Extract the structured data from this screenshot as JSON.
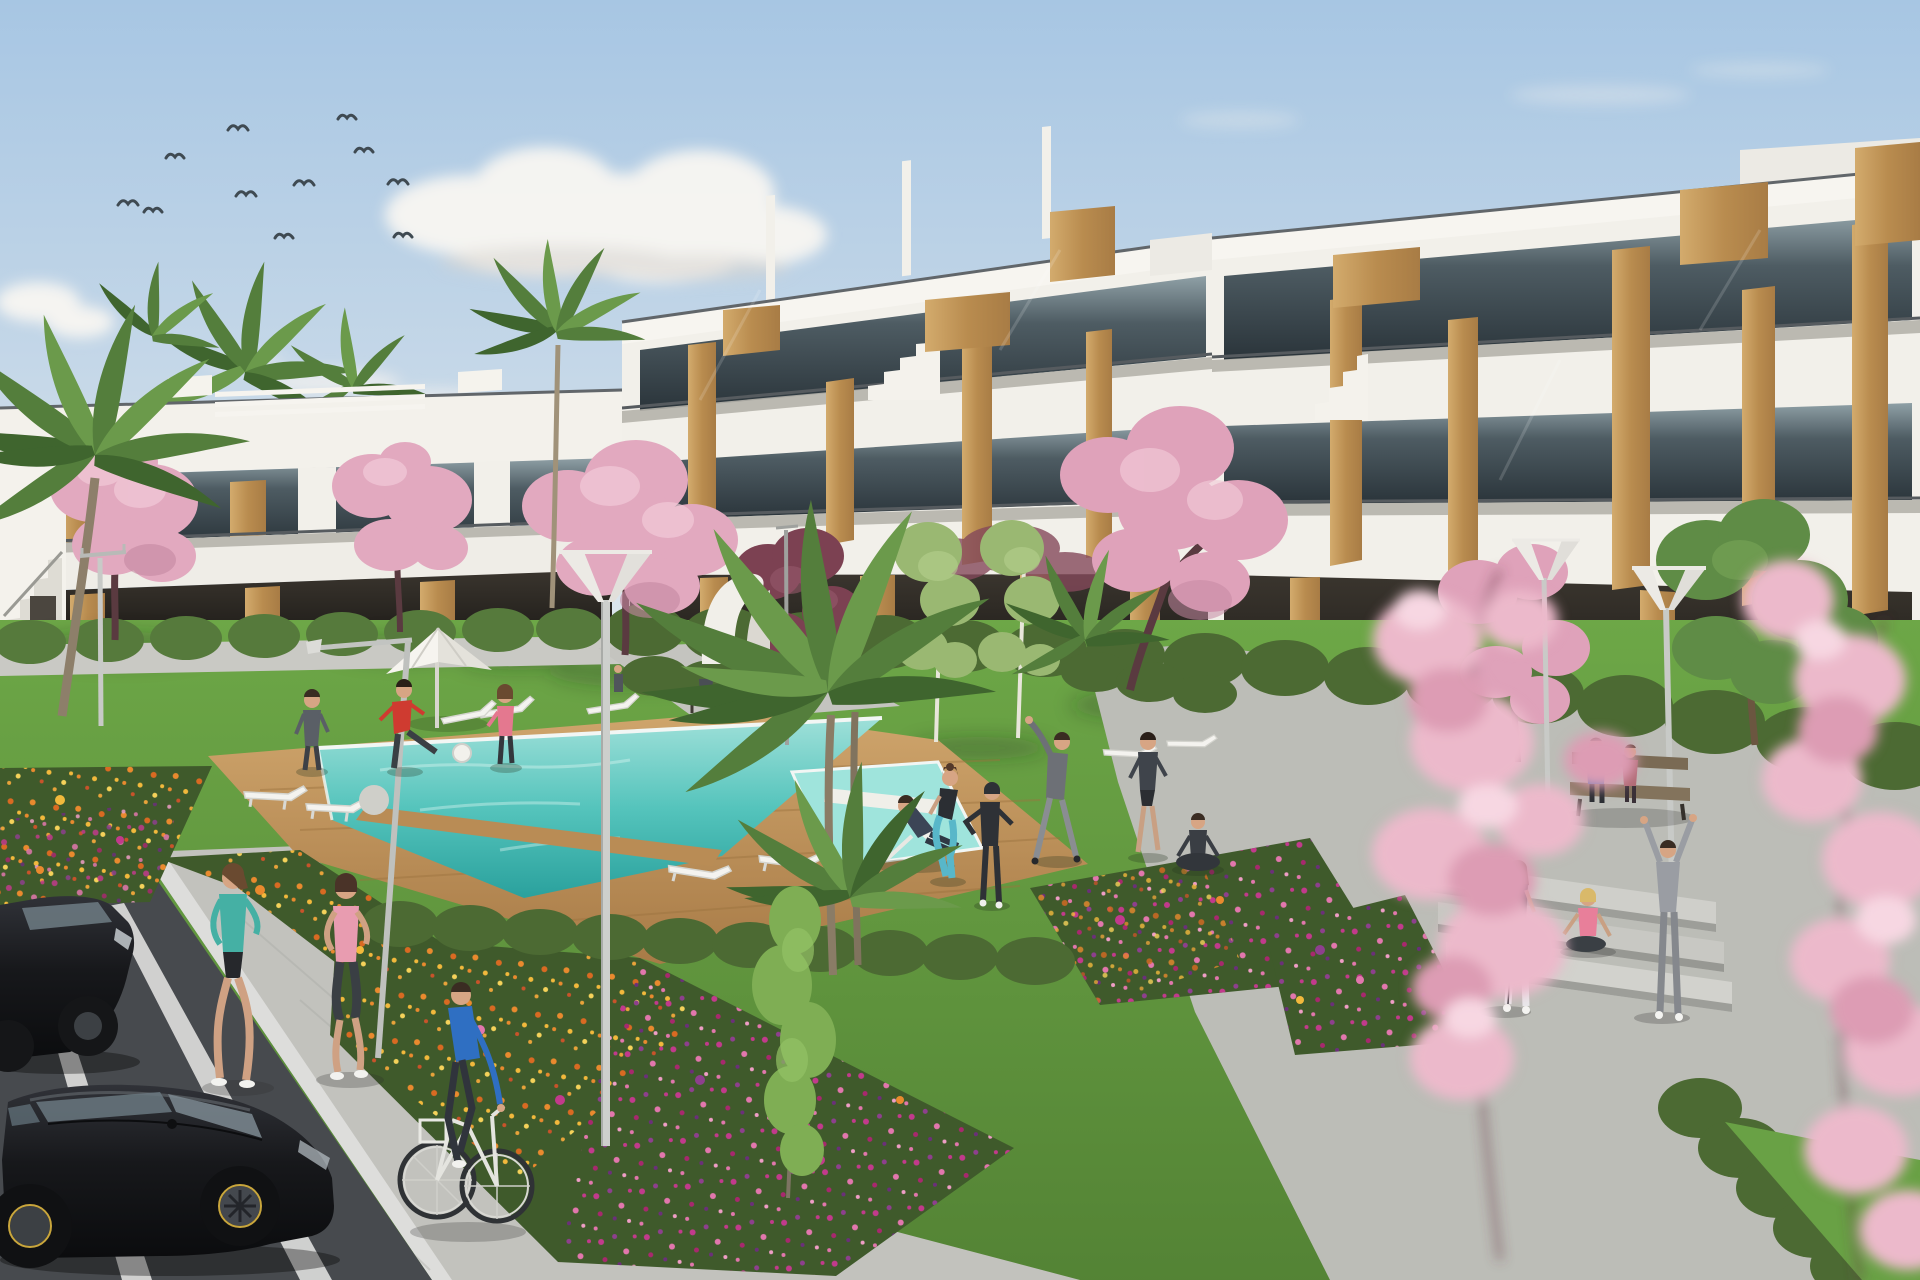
{
  "scene": {
    "type": "photorealistic architectural render",
    "setting": "modern white apartment complex with communal garden, swimming pool and parking on a sunny day",
    "sky": {
      "birds": 11,
      "clouds": "scattered white cumulus and thin wisps"
    },
    "buildings": {
      "right_block": {
        "floors": 3,
        "style": "white modern with glass balconies and timber accent panels",
        "rooftop": "stepped parapets with timber volumes"
      },
      "left_block": {
        "floors": 2,
        "style": "white modern with recessed dark glazing, timber panels and external stair"
      }
    },
    "pool_area": {
      "main_pool": "turquoise pool with wooden deck surround and timber crossing walkway",
      "jacuzzi": "small square pool on the right with white bench plank",
      "sun_loungers": 9,
      "parasols": 1,
      "deck_chairs": 1
    },
    "landscape": {
      "flower_beds": 5,
      "flower_colors": [
        "orange",
        "yellow",
        "magenta",
        "purple",
        "pink"
      ],
      "cherry_blossom_trees": 5,
      "plum_trees": 2,
      "palm_trees": 7,
      "birch_trees": 2,
      "green_trees": 2,
      "hedges": "trimmed rows along buildings and paths",
      "street_lamps": 6,
      "benches": 2,
      "paths": "grey paver walkways with wide steps on the right"
    },
    "vehicles": {
      "parked_cars": 2,
      "car_color": "black",
      "bicycles": 1
    },
    "people_count": 19
  },
  "colors": {
    "sky_top": "#a7c6e3",
    "sky_horizon": "#e3eaee",
    "cloud": "#f8f6f2",
    "wall": "#f2f0ea",
    "wall_shadow": "#b5b2ab",
    "glass": "#45525a",
    "wood": "#c49a5f",
    "railing": "#565b5f",
    "lawn": "#6da747",
    "lawn_deep": "#3f6626",
    "hedge": "#4c6a33",
    "leaf_light": "#9ab872",
    "palm": "#547e3c",
    "blossom": "#ecb9cb",
    "blossom_deep": "#dd9cb4",
    "plum": "#7c4152",
    "water": "#49bdb5",
    "water_light": "#9fe4dc",
    "deck": "#c89d66",
    "path": "#bcbdb7",
    "asphalt": "#474a4e",
    "parking_line": "#e8e8e6",
    "car_black": "#17181b",
    "wheel_accent": "#c9a63c",
    "flower_orange": "#e98a2e",
    "flower_yellow": "#f2b93c",
    "flower_magenta": "#c23a8c",
    "flower_purple": "#8e3f8e",
    "flower_pink": "#e277ad",
    "skin": "#d7a584"
  },
  "people": [
    {
      "id": "jogger-teal",
      "label": "woman jogging in teal top",
      "top": "#45b0a4"
    },
    {
      "id": "jogger-pink",
      "label": "woman jogging in pink top",
      "top": "#e89cb0"
    },
    {
      "id": "cyclist-blue",
      "label": "man cycling in blue shirt",
      "top": "#2f6fc2"
    },
    {
      "id": "ball-player-grey",
      "label": "person in grey by the ball game",
      "top": "#5a5f66"
    },
    {
      "id": "ball-player-red",
      "label": "man in red shirt kicking ball",
      "top": "#cf3b30"
    },
    {
      "id": "ball-player-pink",
      "label": "woman in pink top",
      "top": "#e4788f"
    },
    {
      "id": "woman-with-bag",
      "label": "woman walking with lavender bag",
      "top": "#8d7fae"
    },
    {
      "id": "bench-sitter-small",
      "label": "small figure seated near bench",
      "top": "#4a4e55"
    },
    {
      "id": "man-on-deckchair",
      "label": "man reclining on deck chair",
      "top": "#3c4556"
    },
    {
      "id": "squatting-woman",
      "label": "woman squatting in teal leggings",
      "top": "#2b2e33",
      "legs": "#58b7c9"
    },
    {
      "id": "exerciser-tracksuit",
      "label": "person exercising in black tracksuit",
      "top": "#2e3136"
    },
    {
      "id": "man-stretching",
      "label": "man in grey stretching arm overhead",
      "top": "#6d7076"
    },
    {
      "id": "walking-man",
      "label": "man in dark tee walking",
      "top": "#3f444b"
    },
    {
      "id": "meditating-person",
      "label": "person seated cross-legged",
      "top": "#3a3e44"
    },
    {
      "id": "standing-woman",
      "label": "woman in black tank and white leggings",
      "top": "#26282c",
      "legs": "#e8e8ea"
    },
    {
      "id": "sitting-woman-pink",
      "label": "woman in pink seated on path",
      "top": "#e87f9a"
    },
    {
      "id": "person-arms-raised",
      "label": "person in grey raising both arms",
      "top": "#9a9da3"
    },
    {
      "id": "bench-couple-left",
      "label": "man in blue on bench",
      "top": "#3b6fb5"
    },
    {
      "id": "bench-couple-right",
      "label": "companion in mauve on bench",
      "top": "#b06a74"
    },
    {
      "id": "tiny-distant-figure",
      "label": "distant figure by left building",
      "top": "#50555b"
    }
  ]
}
